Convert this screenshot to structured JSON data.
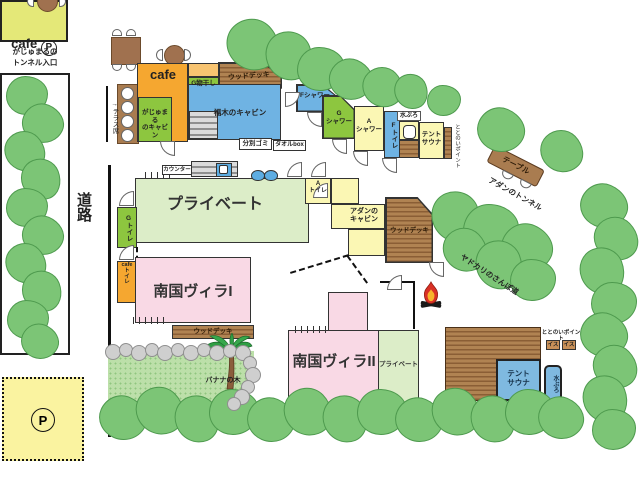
{
  "areas": {
    "cafe_parking": {
      "name": "cafe",
      "p": "P"
    },
    "tunnel_entrance": "がじゅまるの\nトンネル入口",
    "road": "道路",
    "terrace": "→テラス席",
    "cafe": "cafe",
    "g_monohoshi": "G物干し",
    "wood_deck_top": "ウッドデッキ",
    "fukugi_cabin": "福木のキャビン",
    "gajumaru_cabin": "がじゅまる\nのキャビン",
    "bunbetsu_gomi": "分別ゴミ",
    "towel_box": "タオルbox",
    "f_shower": "Fシャワー",
    "g_shower": "G\nシャワー",
    "a_shower": "A\nシャワー",
    "f_toilet": "Fトイレ",
    "mizuburo_top": "水ぶろ",
    "tent_sauna_top": "テント\nサウナ",
    "totonoi_top": "ととのいポイント",
    "table": "テーブル",
    "adan_tunnel": "アダンのトンネル",
    "counter": "カウンター",
    "private_main": "プライベート",
    "a_toilet": "A\nトイレ",
    "adan_cabin": "アダンの\nキャビン",
    "wood_deck_adan": "ウッドデッキ",
    "g_toilet": "Gトイレ",
    "cafe_toilet": "cafe\nト\nイ\nレ",
    "villa1": "南国ヴィラI",
    "wood_deck_villa1": "ウッドデッキ",
    "banana_tree": "バナナの木",
    "villa2": "南国ヴィラII",
    "private_villa2": "プライベート",
    "yadokari_path": "ヤドカリのさんぽ道",
    "totonoi_bottom": "ととのいポイント",
    "isu1": "イス",
    "isu2": "イス",
    "tent_sauna_bottom": "テント\nサウナ",
    "mizuburo_bottom": "水ぶろ",
    "parking_p": "P"
  },
  "colors": {
    "building_orange": "#F5A730",
    "light_orange": "#F8C471",
    "building_yellow": "#FBF7B4",
    "building_green": "#8DC63F",
    "building_blue": "#6FB3E3",
    "sauna_blue": "#7FB9E0",
    "villa_pink": "#F9D9E5",
    "private_green": "#DCEDC8",
    "wood_brown": "#A97C50",
    "tree_green": "#7CC576",
    "cafe_parking_yellow": "#E4E878",
    "parking_yellow": "#FAF3A0"
  }
}
